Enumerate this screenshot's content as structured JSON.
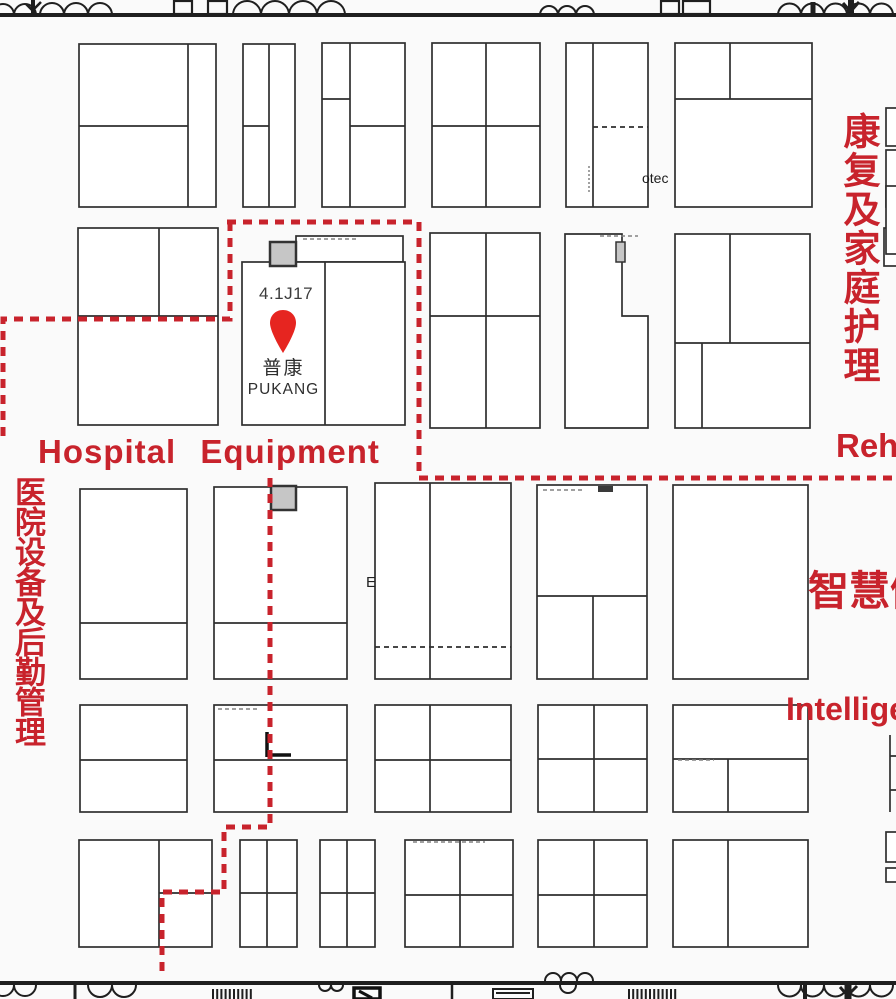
{
  "palette": {
    "zone_red": "#c8232c",
    "pin_red": "#e62520",
    "wall_black": "#1f1f1f",
    "booth_outline": "#2f2f2f",
    "marker_gray": "#c6c6c6"
  },
  "pin_booth": {
    "code": "4.1J17",
    "name_cn": "普康",
    "name_en": "PUKANG"
  },
  "labels": {
    "hospital_equipment": "Hospital Equipment",
    "left_zone_vertical": "医院设备及后勤管理",
    "right_zone_vertical": "康复及家庭护理",
    "rehab_partial": "Reh",
    "smart_health_partial": "智慧健",
    "intelligent_partial": "Intellige",
    "otec": "otec",
    "booth_mark_e": "E"
  }
}
